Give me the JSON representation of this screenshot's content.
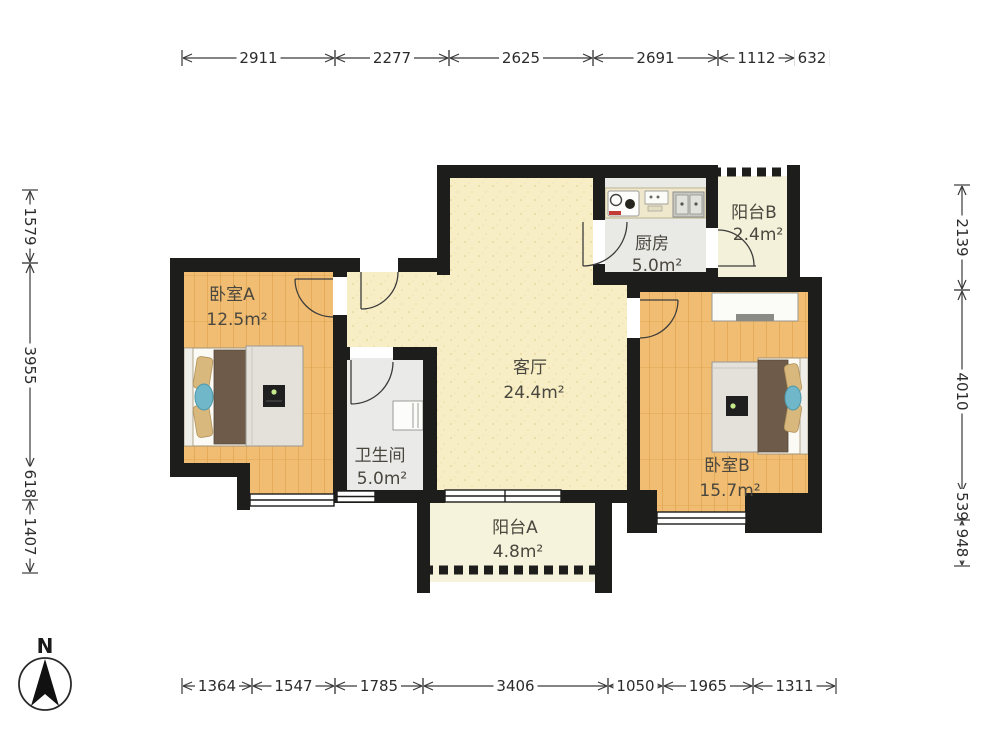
{
  "plan_title": "two-bedroom apartment floor plan",
  "compass": {
    "label": "N"
  },
  "rooms": [
    {
      "id": "bedroom-a",
      "name": "卧室A",
      "area": "12.5m²"
    },
    {
      "id": "bathroom",
      "name": "卫生间",
      "area": "5.0m²"
    },
    {
      "id": "kitchen",
      "name": "厨房",
      "area": "5.0m²"
    },
    {
      "id": "balcony-b",
      "name": "阳台B",
      "area": "2.4m²"
    },
    {
      "id": "living-room",
      "name": "客厅",
      "area": "24.4m²"
    },
    {
      "id": "bedroom-b",
      "name": "卧室B",
      "area": "15.7m²"
    },
    {
      "id": "balcony-a",
      "name": "阳台A",
      "area": "4.8m²"
    }
  ],
  "dimensions": {
    "top": [
      "2911",
      "2277",
      "2625",
      "2691",
      "1112",
      "632"
    ],
    "bottom": [
      "1364",
      "1547",
      "1785",
      "3406",
      "1050",
      "1965",
      "1311"
    ],
    "left": [
      "1579",
      "3955",
      "618",
      "1407"
    ],
    "right": [
      "2139",
      "4010",
      "539",
      "948"
    ]
  },
  "icons": {
    "compass": "north-arrow-icon",
    "doors": "door-swing-arc",
    "windows": "triple-line-window"
  },
  "colors": {
    "wall": "#1d1d1b",
    "wood_floor": "#f1bd72",
    "living_floor": "#f7eec6",
    "balcony_floor": "#f6f3dc",
    "tile_floor": "#e9e9e6",
    "duvet_brown": "#6e5b49",
    "pillow_tan": "#d8b87c",
    "cushion_teal": "#6fb7c9",
    "dim_line": "#3a3a3a"
  }
}
